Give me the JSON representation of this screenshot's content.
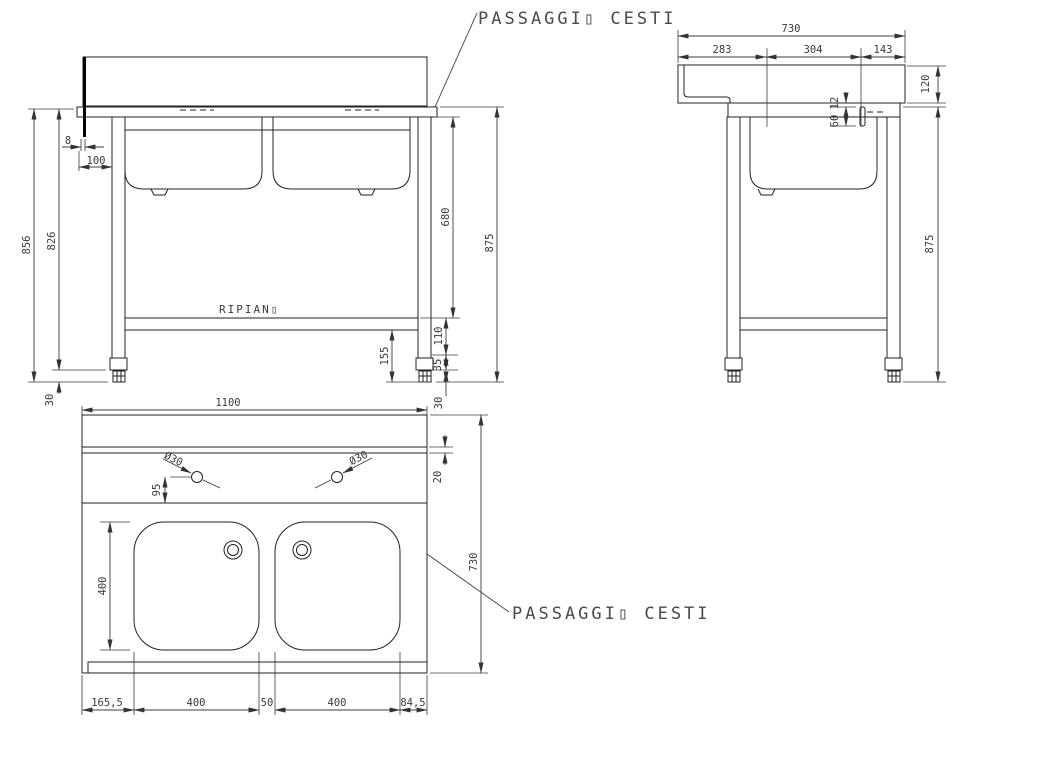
{
  "labels": {
    "title_top": "PASSAGGI▯ CESTI",
    "title_bottom": "PASSAGGI▯ CESTI",
    "ripiano": "RIPIAN▯"
  },
  "colors": {
    "line": "#222222",
    "text": "#3a3a3a",
    "background": "#ffffff"
  },
  "front_view": {
    "d8": "8",
    "d100": "100",
    "d856": "856",
    "d826": "826",
    "d30_left": "30",
    "d680": "680",
    "d110": "110",
    "d35": "35",
    "d30_right": "30",
    "d155": "155",
    "d875": "875"
  },
  "side_view": {
    "d730": "730",
    "d283": "283",
    "d304": "304",
    "d143": "143",
    "d120": "120",
    "d12": "12",
    "d60": "60",
    "d875": "875"
  },
  "plan_view": {
    "d1100": "1100",
    "d20": "20",
    "d95": "95",
    "dia_left": "Ø30",
    "dia_right": "Ø30",
    "d400_side": "400",
    "d730": "730",
    "d165": "165,5",
    "d400_a": "400",
    "d50": "50",
    "d400_b": "400",
    "d84": "84,5"
  }
}
